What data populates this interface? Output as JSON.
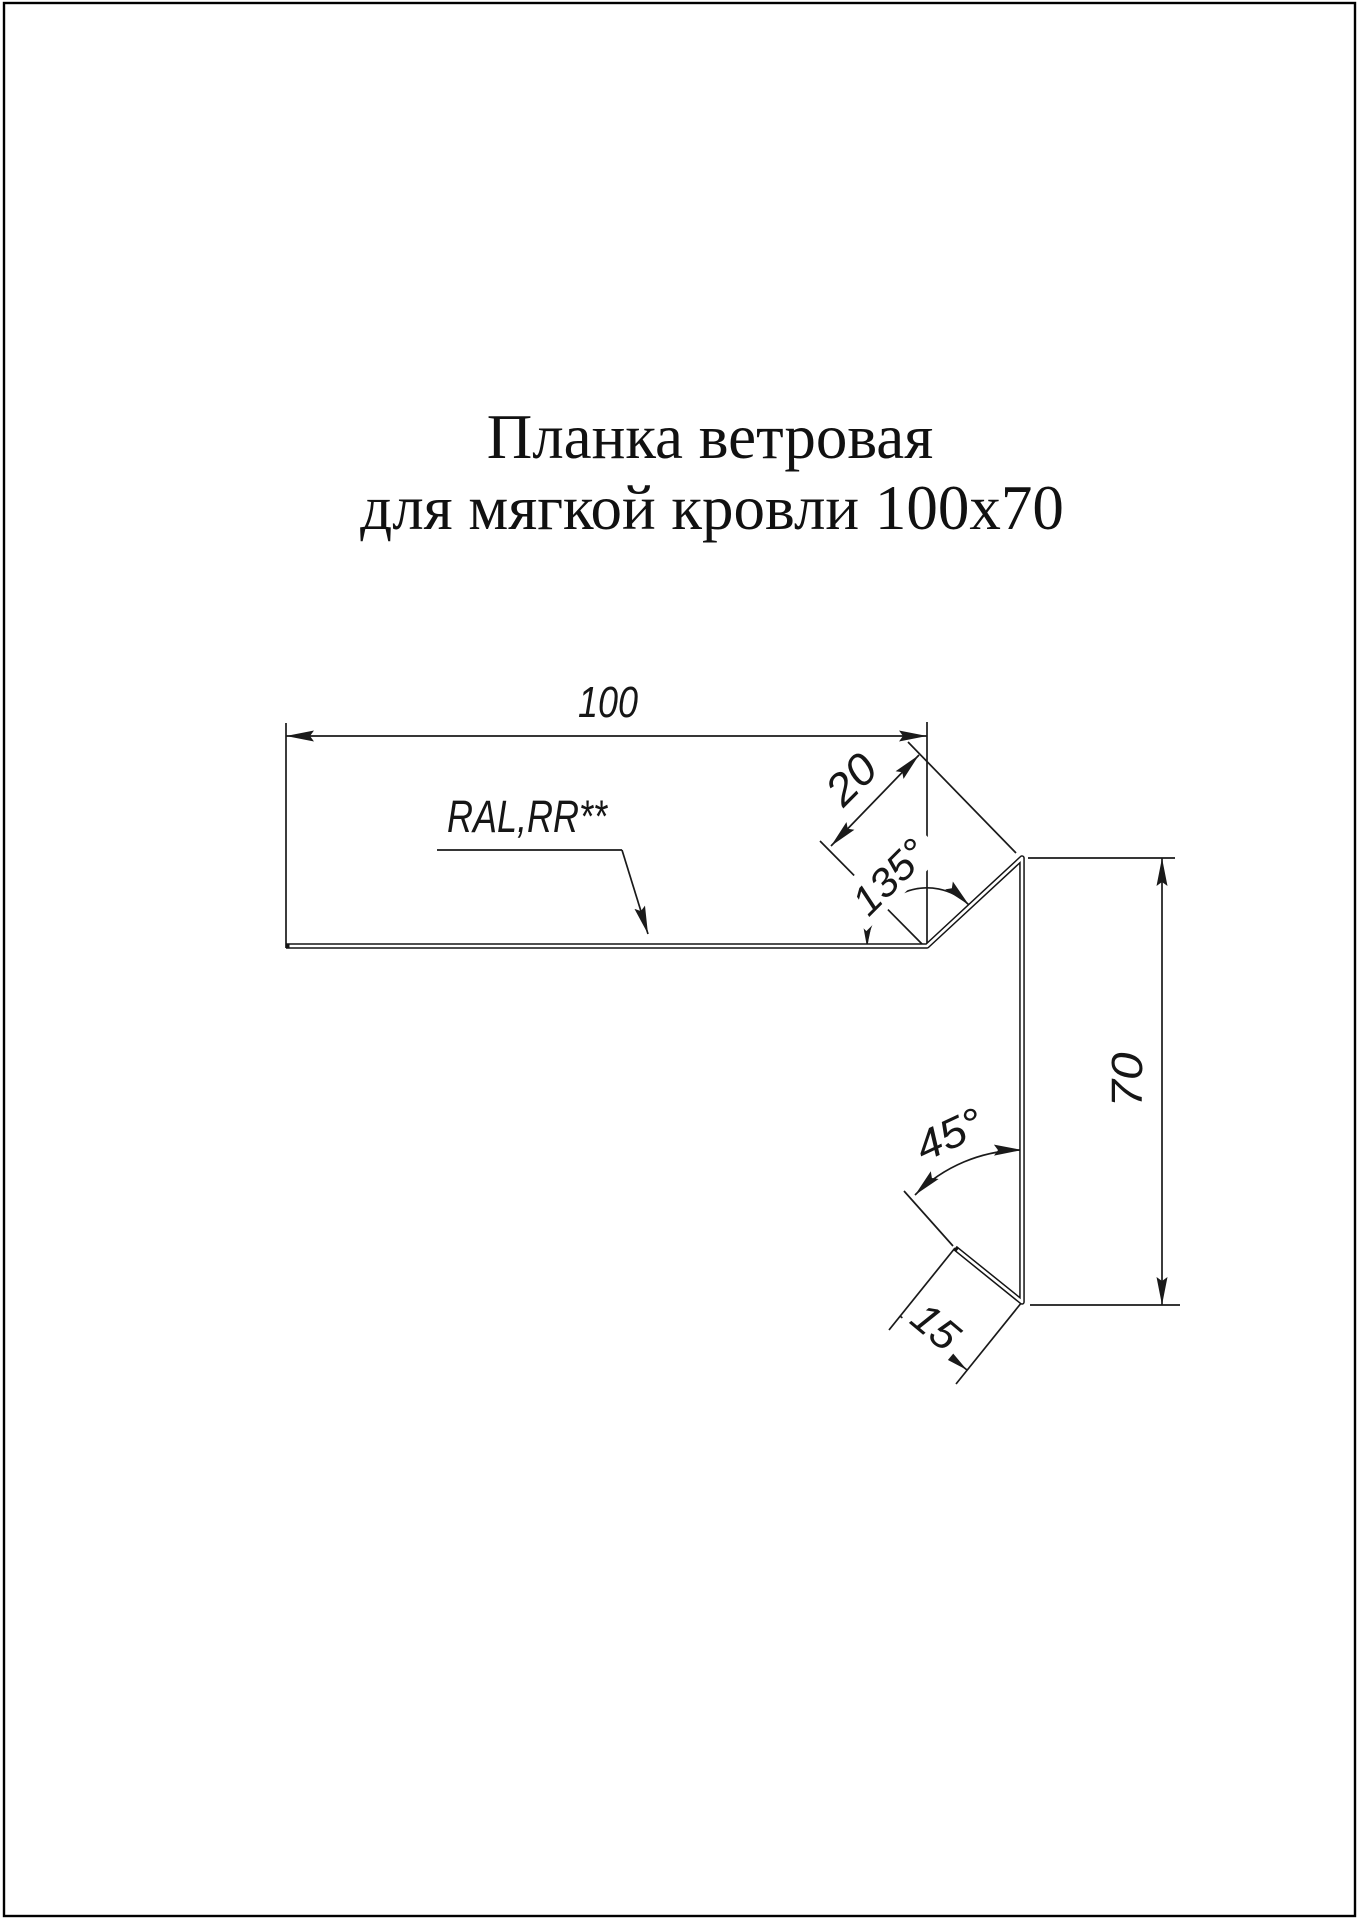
{
  "page": {
    "background": "#ffffff",
    "border_color": "#000000",
    "line_color": "#1a1a1a"
  },
  "title": {
    "line1": "Планка ветровая",
    "line2": "для мягкой кровли 100x70"
  },
  "drawing": {
    "coating_label": "RAL,RR**",
    "dimensions": {
      "top_width": "100",
      "bend_drop": "20",
      "top_bend_angle": "135°",
      "side_height": "70",
      "hem_angle": "45°",
      "hem_length": "15"
    }
  }
}
